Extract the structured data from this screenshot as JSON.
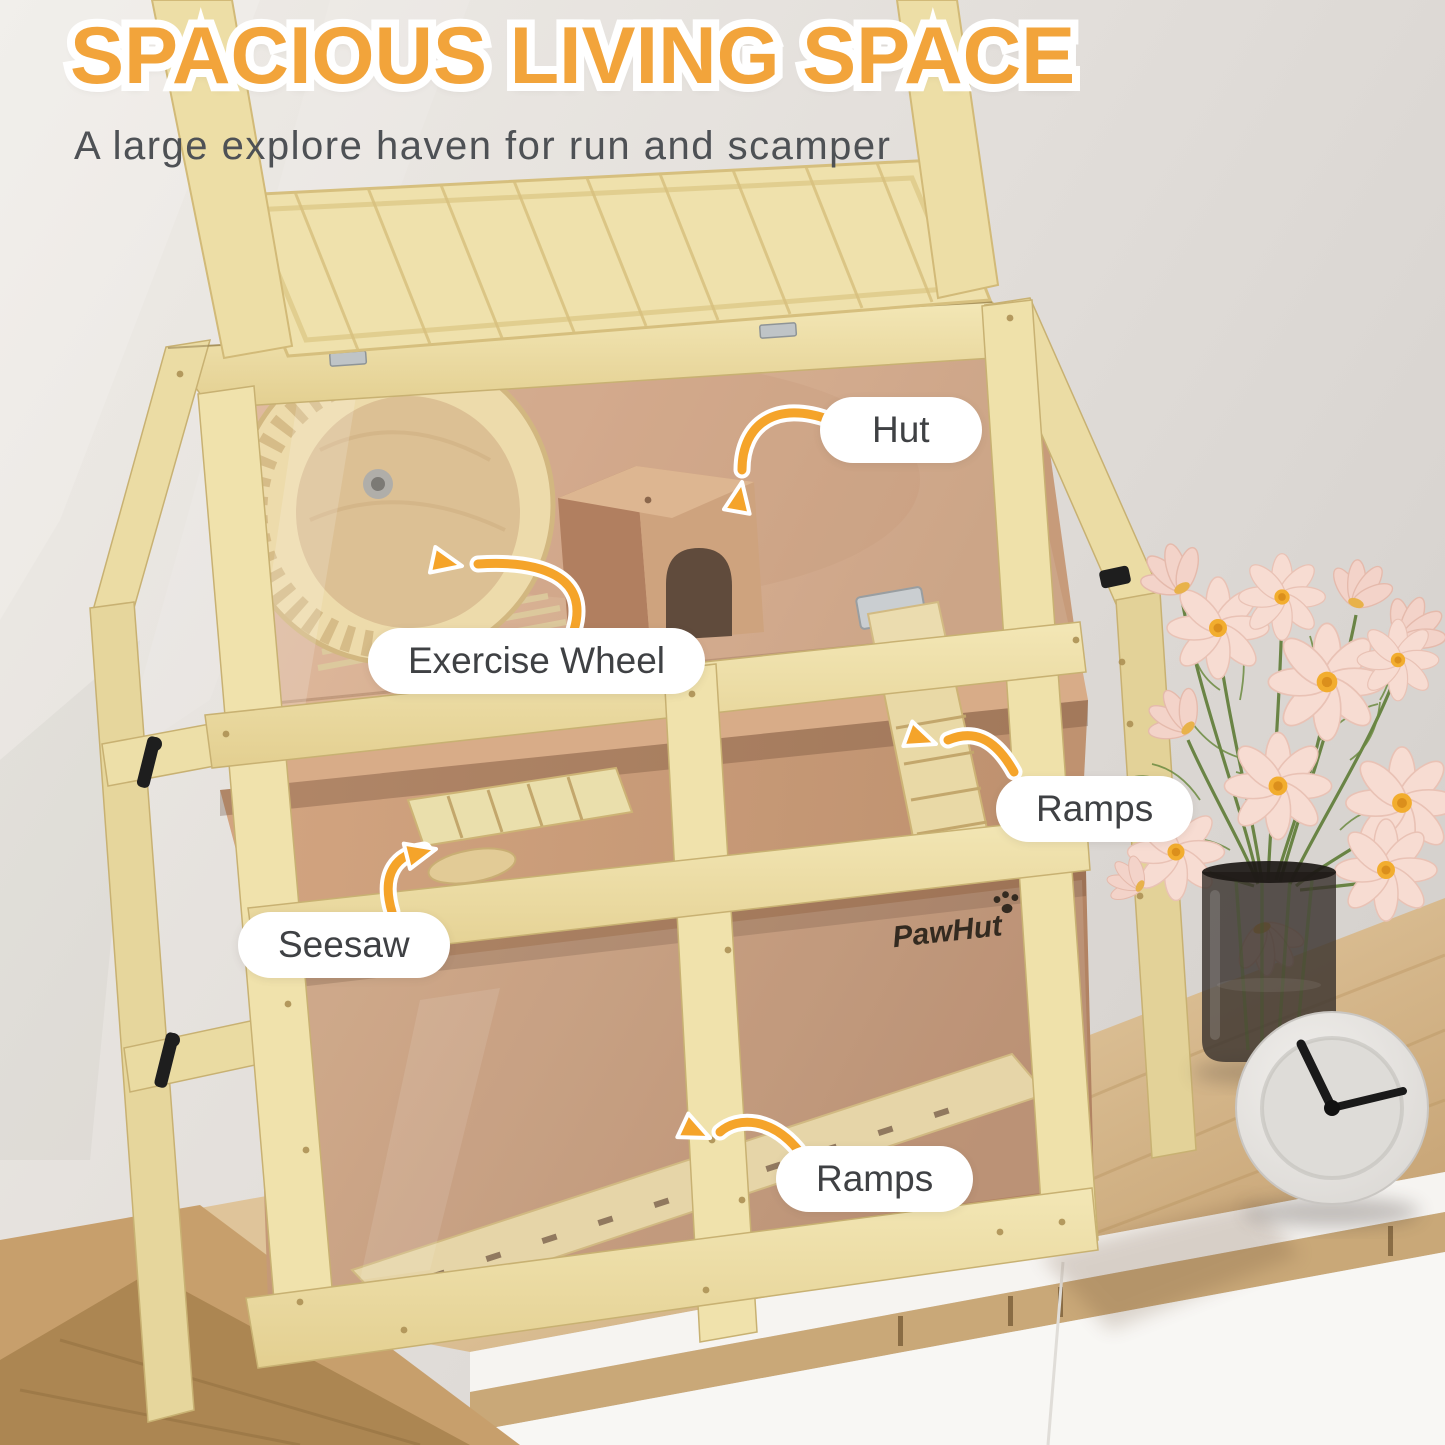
{
  "header": {
    "title": "SPACIOUS LIVING SPACE",
    "subtitle": "A large explore haven for run and scamper"
  },
  "callouts": [
    {
      "id": "hut",
      "label": "Hut"
    },
    {
      "id": "exercise-wheel",
      "label": "Exercise Wheel"
    },
    {
      "id": "ramps-upper",
      "label": "Ramps"
    },
    {
      "id": "seesaw",
      "label": "Seesaw"
    },
    {
      "id": "ramps-lower",
      "label": "Ramps"
    }
  ],
  "brand": {
    "logo_text": "PawHut"
  },
  "colors": {
    "title_orange": "#F2A43B",
    "arrow_orange": "#F5A42A",
    "callout_bg": "#FFFFFF",
    "callout_text": "#3F4144",
    "subtitle_gray": "#4E5155"
  },
  "visible_objects": [
    "wooden hamster cage with open top lid",
    "exercise wheel",
    "hut with arched door",
    "upper ramp",
    "seesaw",
    "lower ramp",
    "pink cosmos bouquet in glass vase",
    "round white desk clock",
    "oak sideboard with white drawers"
  ]
}
